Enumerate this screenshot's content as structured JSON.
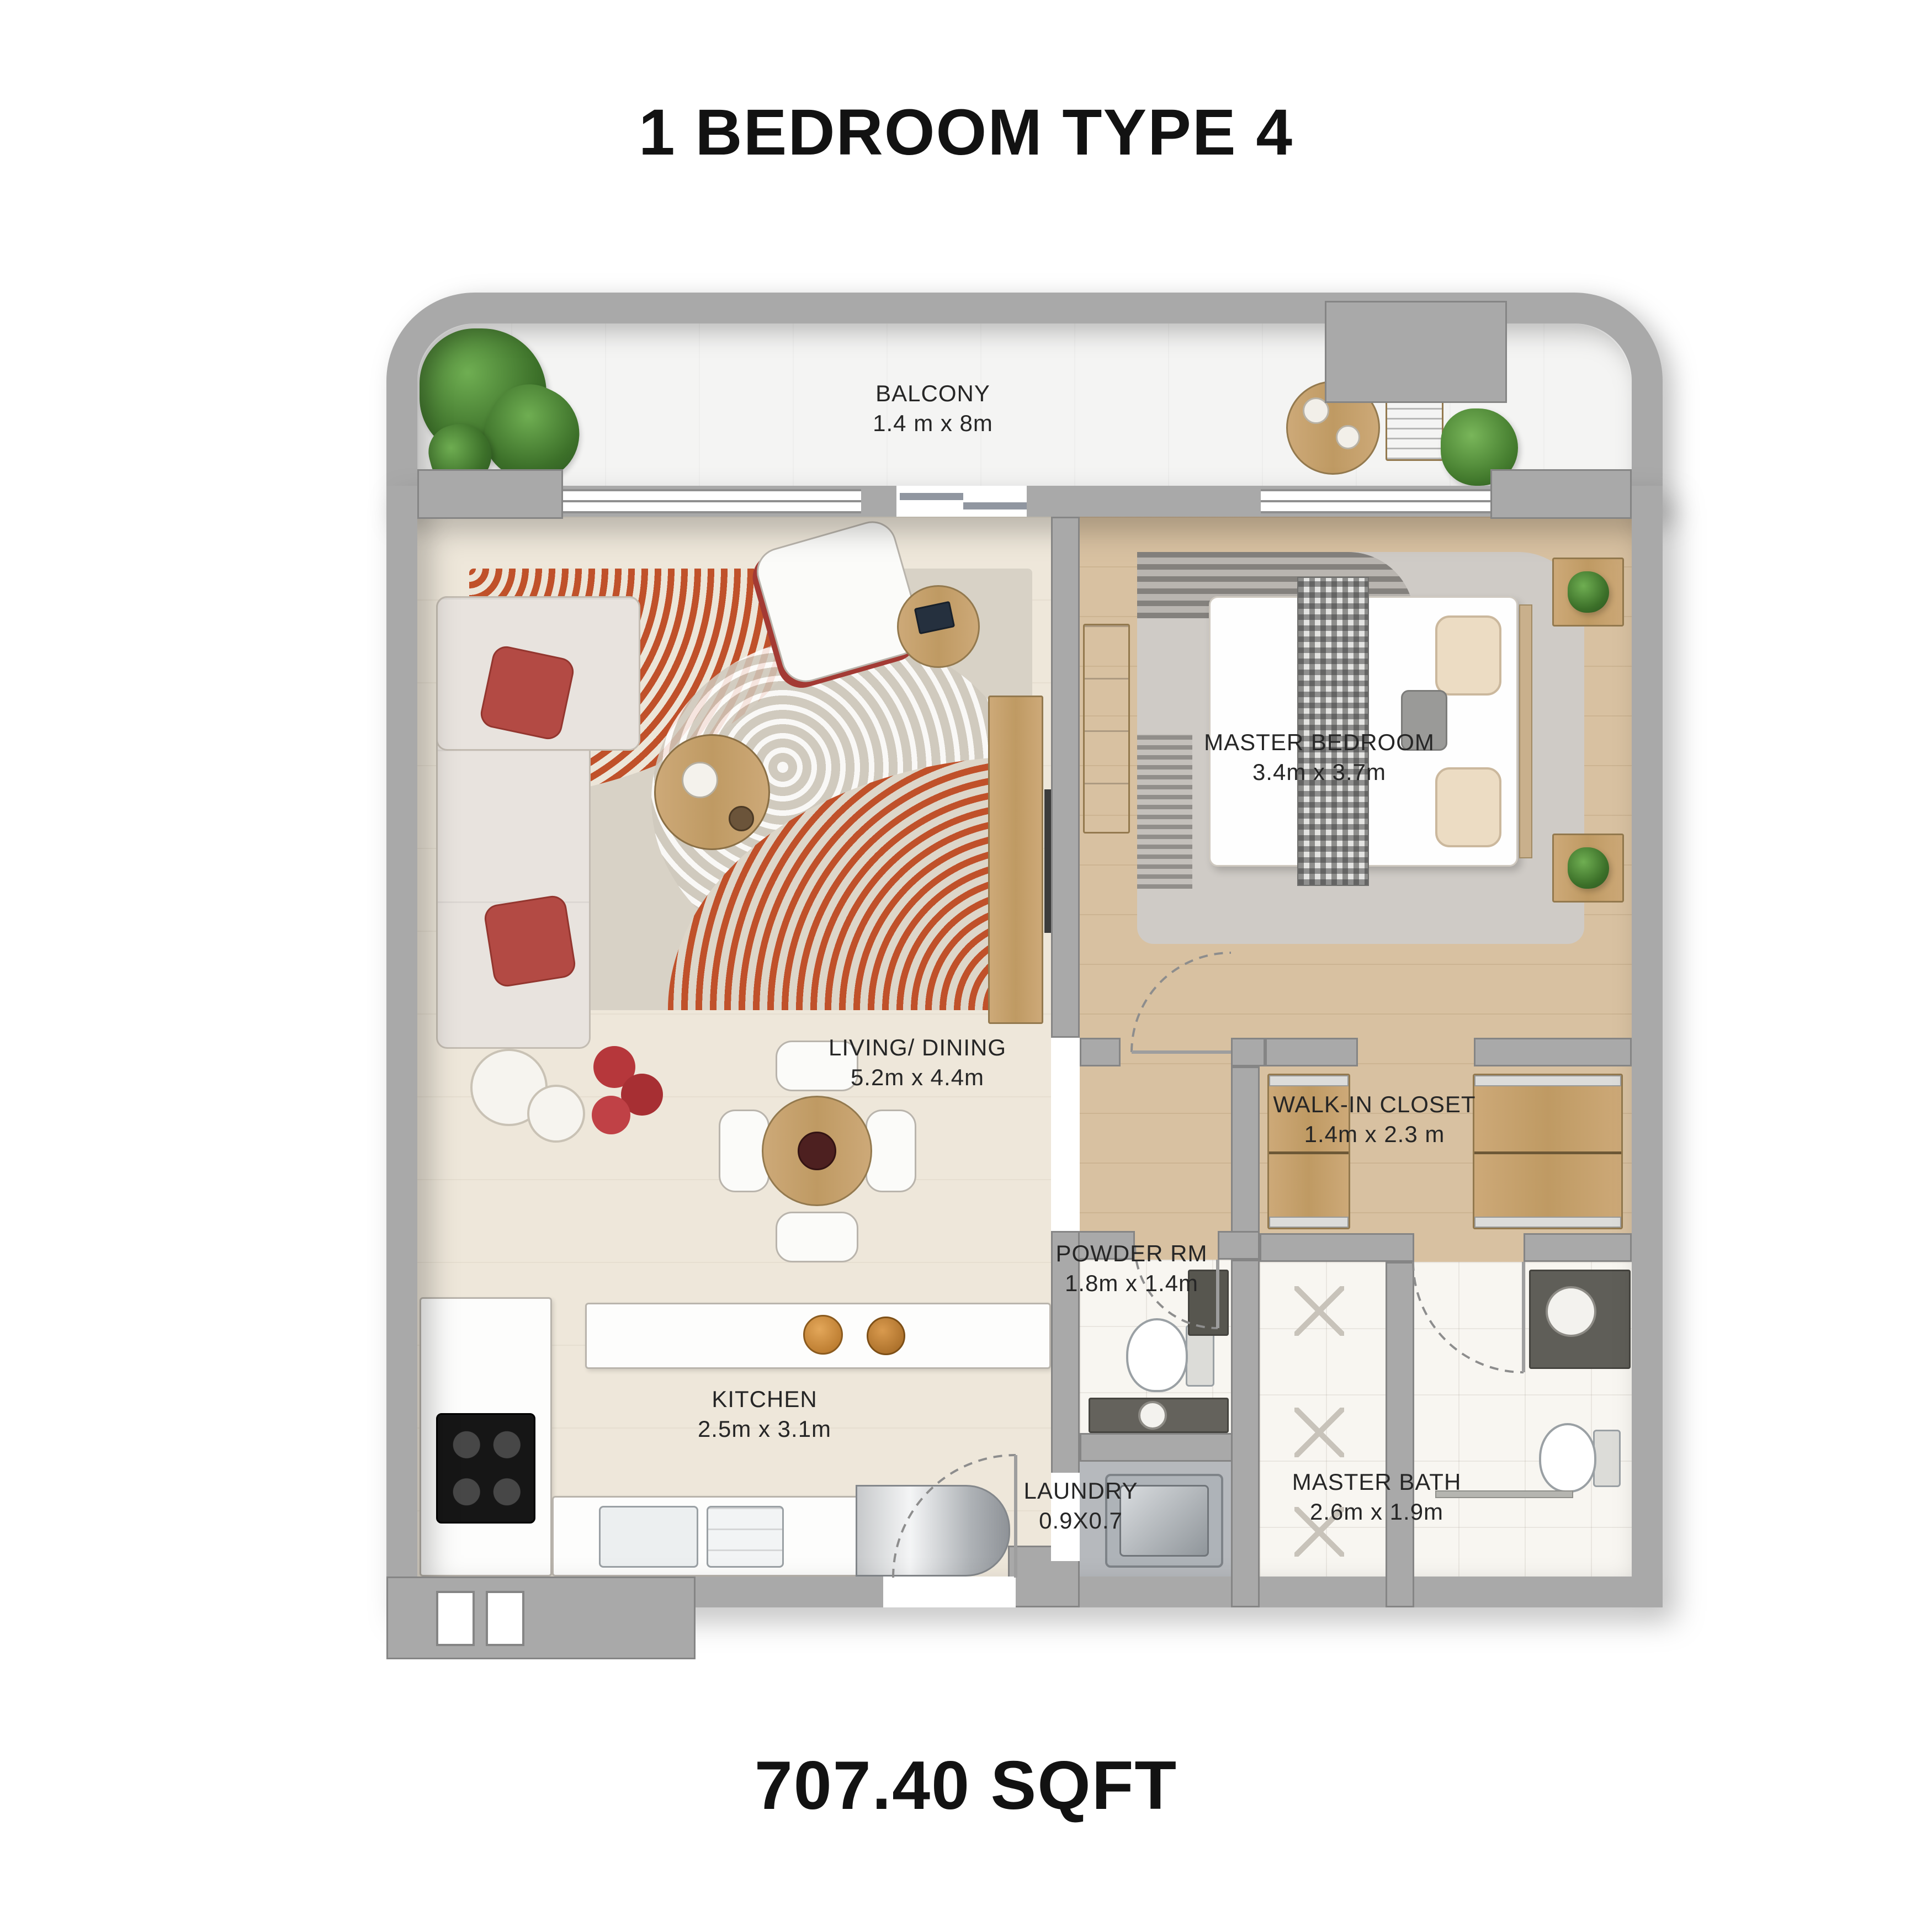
{
  "title": "1 BEDROOM TYPE 4",
  "area_label": "707.40 SQFT",
  "rooms": {
    "balcony": {
      "name": "BALCONY",
      "dims": "1.4 m x 8m"
    },
    "living_dining": {
      "name": "LIVING/ DINING",
      "dims": "5.2m x 4.4m"
    },
    "master_bedroom": {
      "name": "MASTER BEDROOM",
      "dims": "3.4m x 3.7m"
    },
    "walk_in_closet": {
      "name": "WALK-IN CLOSET",
      "dims": "1.4m x 2.3 m"
    },
    "powder_room": {
      "name": "POWDER RM",
      "dims": "1.8m x 1.4m"
    },
    "kitchen": {
      "name": "KITCHEN",
      "dims": "2.5m x 3.1m"
    },
    "laundry": {
      "name": "LAUNDRY",
      "dims": "0.9X0.7"
    },
    "master_bath": {
      "name": "MASTER BATH",
      "dims": "2.6m x 1.9m"
    }
  },
  "palette": {
    "wall_gray": "#a9a9a9",
    "wall_edge": "#858585",
    "living_floor": "#eee7da",
    "wood_floor": "#d8c1a1",
    "tile_floor": "#f8f6f1",
    "balcony_floor": "#f4f4f3",
    "rug_orange": "#c0512a",
    "pillow_red": "#b34a44",
    "wood_furniture": "#c5a474",
    "plant_green": "#4e8f3a",
    "text_color": "#1f1f1f"
  }
}
